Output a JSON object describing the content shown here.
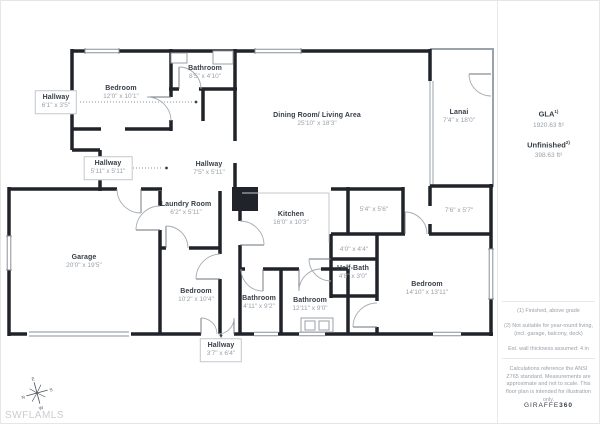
{
  "watermark": "SWFLAMLS",
  "compass": {
    "n": "N",
    "e": "E",
    "s": "S",
    "w": "W"
  },
  "rooms": {
    "bedroom_top": {
      "name": "Bedroom",
      "dims": "12'0\" x 10'1\""
    },
    "bathroom_top": {
      "name": "Bathroom",
      "dims": "8'5\" x 4'10\""
    },
    "hallway_1": {
      "name": "Hallway",
      "dims": "6'1\" x 3'5\""
    },
    "hallway_2": {
      "name": "Hallway",
      "dims": "5'11\" x 5'11\""
    },
    "hallway_3": {
      "name": "Hallway",
      "dims": "7'5\" x 5'11\""
    },
    "dining_living": {
      "name": "Dining Room/ Living Area",
      "dims": "25'10\" x 18'3\""
    },
    "lanai": {
      "name": "Lanai",
      "dims": "7'4\" x 18'0\""
    },
    "laundry": {
      "name": "Laundry Room",
      "dims": "6'2\" x 5'11\""
    },
    "kitchen": {
      "name": "Kitchen",
      "dims": "16'0\" x 10'3\""
    },
    "closet_a": {
      "dims": "5'4\" x 5'6\""
    },
    "closet_b": {
      "dims": "7'6\" x 5'7\""
    },
    "closet_c": {
      "dims": "4'0\" x 4'4\""
    },
    "half_bath": {
      "name": "Half-Bath",
      "dims": "4'8\" x 3'0\""
    },
    "garage": {
      "name": "Garage",
      "dims": "20'0\" x 19'5\""
    },
    "bedroom_mid": {
      "name": "Bedroom",
      "dims": "10'2\" x 10'4\""
    },
    "bathroom_mid": {
      "name": "Bathroom",
      "dims": "4'11\" x 9'2\""
    },
    "bathroom_main": {
      "name": "Bathroom",
      "dims": "12'11\" x 9'0\""
    },
    "bedroom_right": {
      "name": "Bedroom",
      "dims": "14'10\" x 13'11\""
    },
    "hallway_4": {
      "name": "Hallway",
      "dims": "3'7\" x 6'4\""
    }
  },
  "sidebar": {
    "gla_label": "GLA",
    "gla_sup": "1)",
    "gla_value": "1920.63 ft²",
    "unfinished_label": "Unfinished",
    "unfinished_sup": "2)",
    "unfinished_value": "398.63 ft²",
    "footnote_1": "(1) Finished, above grade",
    "footnote_2": "(2) Not suitable for year-round living,",
    "footnote_3": "(incl. garage, balcony, deck)",
    "footnote_4": "Est. wall thickness assumed: 4 in",
    "disclaimer": "Calculations reference the ANSI Z765 standard. Measurements are approximate and not to scale. This floor plan is intended for illustration only.",
    "brand_name": "GIRAFFE",
    "brand_suffix": "360"
  }
}
